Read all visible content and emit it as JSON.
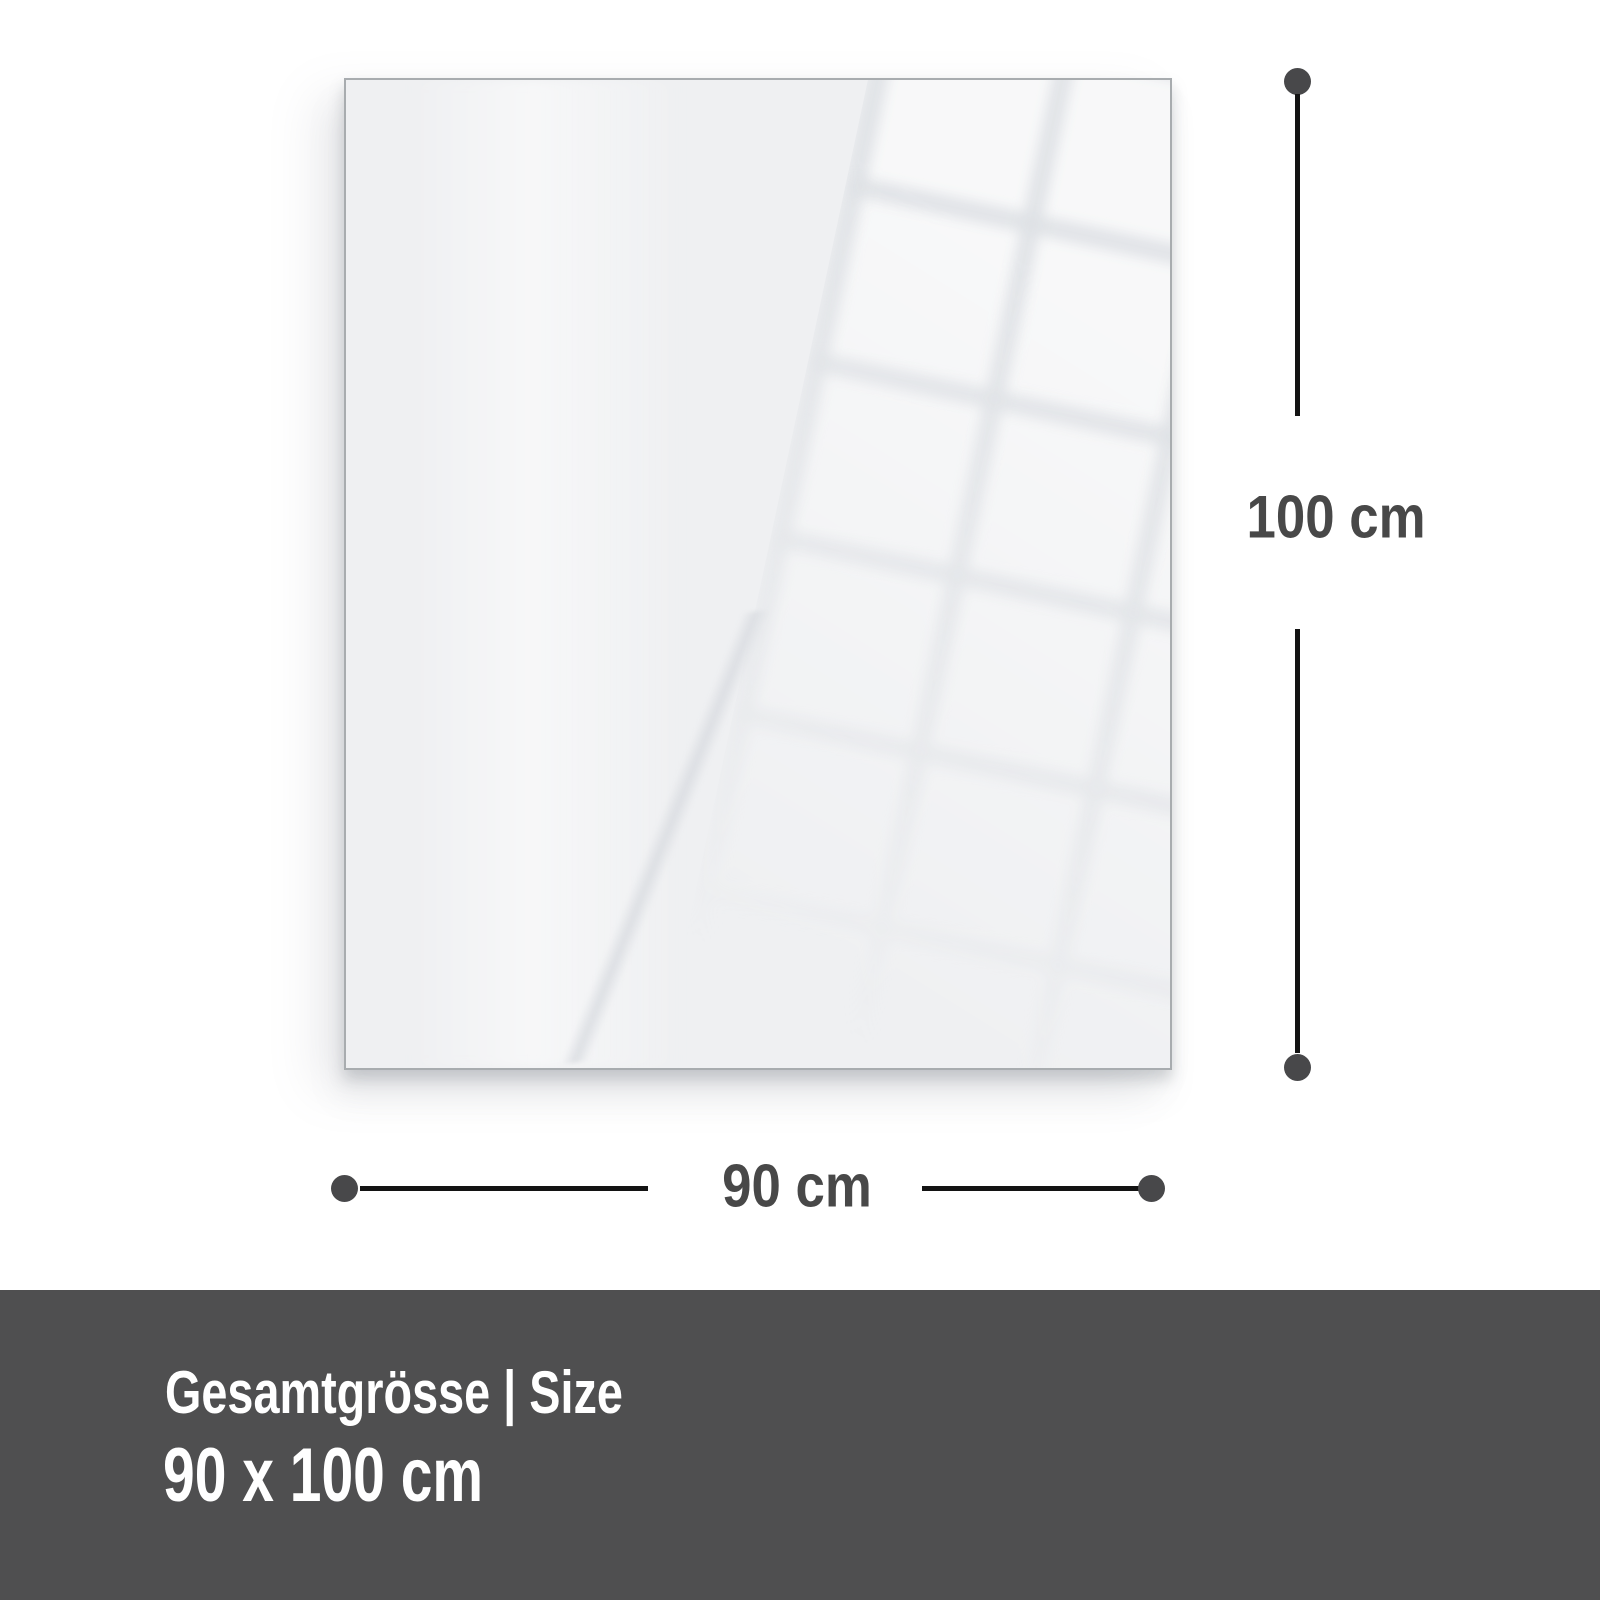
{
  "panel": {
    "base_color": "#eff0f2",
    "border_color": "#a8acaf"
  },
  "dimensions": {
    "height": {
      "label": "100 cm"
    },
    "width": {
      "label": "90 cm"
    },
    "line_color": "#131313",
    "dot_color": "#48484a",
    "label_color": "#484848"
  },
  "footer": {
    "title": "Gesamtgrösse | Size",
    "value": "90 x 100 cm",
    "background": "#4f4f50",
    "text_color": "#ffffff"
  }
}
